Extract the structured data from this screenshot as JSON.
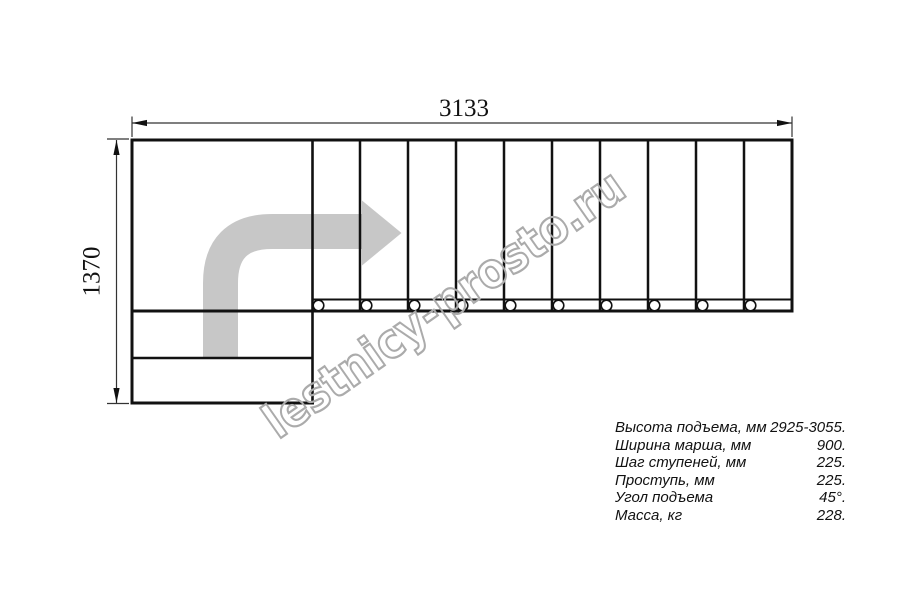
{
  "diagram": {
    "type": "staircase-plan-drawing",
    "watermark": "lestnicy-prosto.ru",
    "dimensions": {
      "width_label": "3133",
      "height_label": "1370"
    },
    "structure": {
      "tread_count": 10,
      "baluster_count": 10,
      "landing_lower_steps": 2,
      "turn": "L-shaped, quarter turn, direction arrow up-then-right"
    }
  },
  "specs": {
    "rows": [
      {
        "label": "Высота подъема, мм",
        "value": "2925-3055."
      },
      {
        "label": "Ширина марша, мм",
        "value": "900."
      },
      {
        "label": "Шаг ступеней, мм",
        "value": "225."
      },
      {
        "label": "Проступь, мм",
        "value": "225."
      },
      {
        "label": "Угол подъема",
        "value": "45°."
      },
      {
        "label": "Масса, кг",
        "value": "228."
      }
    ]
  },
  "colors": {
    "line": "#111111",
    "dimension_line": "#333333",
    "arrow_fill": "#c7c7c7",
    "watermark_stroke": "#ababab",
    "background": "#ffffff"
  }
}
